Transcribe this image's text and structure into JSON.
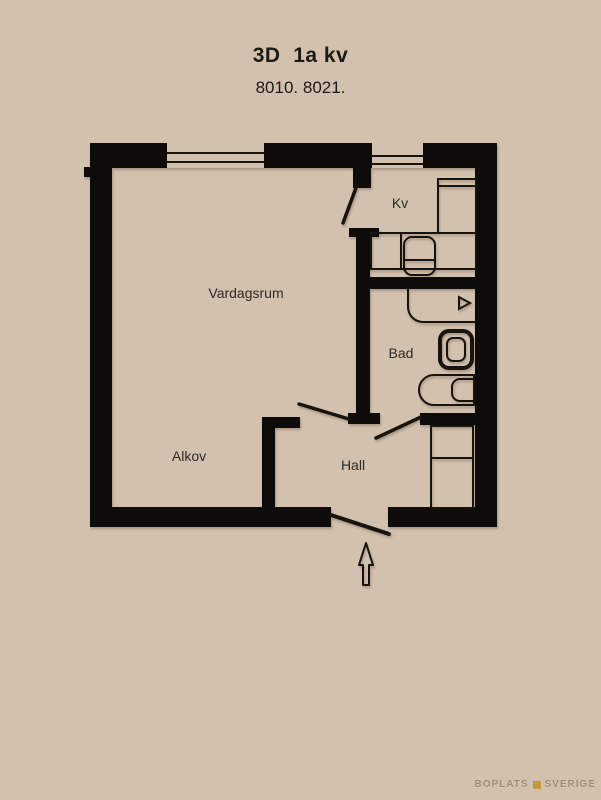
{
  "title": "3D  1a kv",
  "subtitle": "8010. 8021.",
  "rooms": {
    "vardagsrum": "Vardagsrum",
    "kitchen": "Kv",
    "bathroom": "Bad",
    "hall": "Hall",
    "alcove": "Alkov"
  },
  "watermark": {
    "left": "BOPLATS",
    "right": "SVERIGE"
  },
  "colors": {
    "background": "#d2c1ae",
    "wall": "#0d0c0a",
    "line": "#17130e",
    "text": "#2e2a26",
    "watermark_gold": "#c19a3f"
  }
}
